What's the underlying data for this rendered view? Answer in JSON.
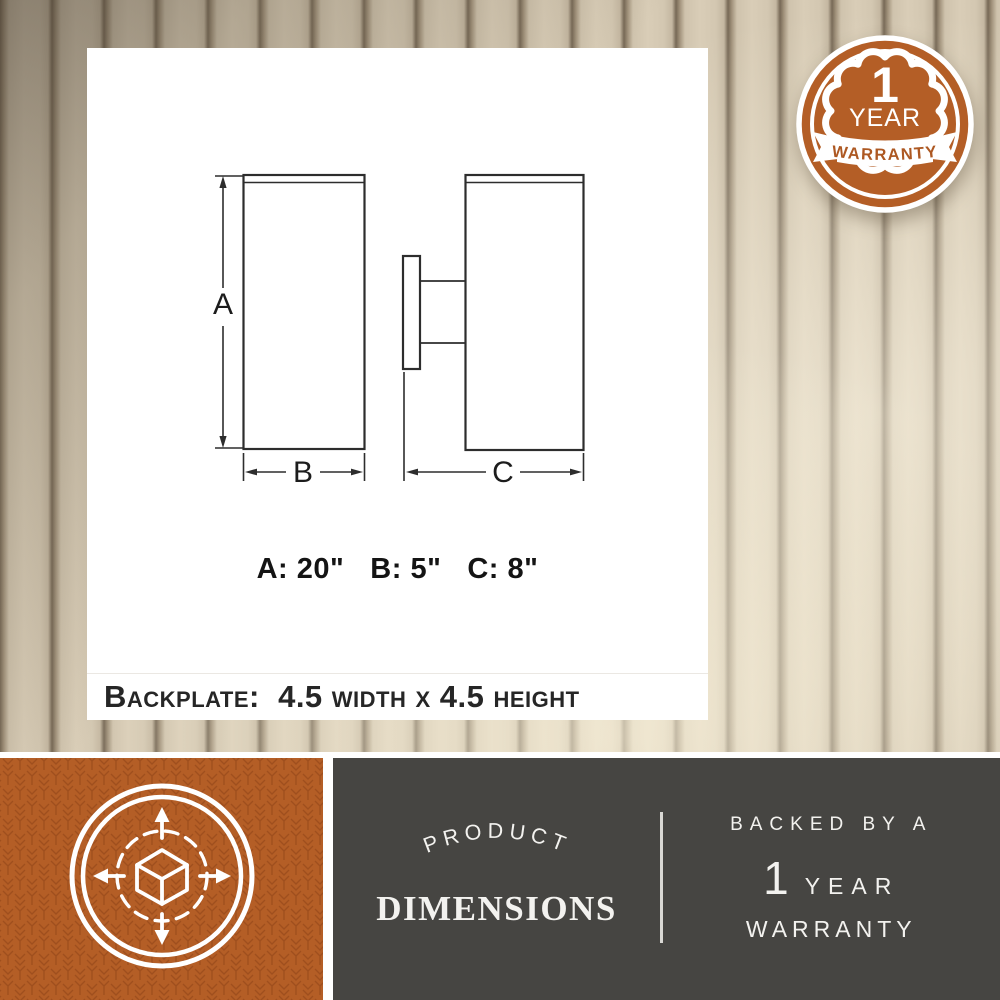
{
  "panel": {
    "labels": {
      "a": "A",
      "b": "B",
      "c": "C"
    },
    "dims": {
      "a": "A: 20\"",
      "b": "B: 5\"",
      "c": "C: 8\""
    },
    "backplate": "Backplate:  4.5 width x 4.5 height"
  },
  "badge": {
    "number": "1",
    "year": "YEAR",
    "banner": "WARRANTY"
  },
  "bottom": {
    "arc_text": "PRODUCT",
    "title": "DIMENSIONS",
    "backed": "BACKED BY A",
    "year_number": "1",
    "year_word": "YEAR",
    "warranty": "WARRANTY"
  },
  "icons": {
    "badge": "1-year-warranty-seal",
    "cube": "3d-cube-dimensions-icon"
  },
  "colors": {
    "orange": "#b45e26",
    "orange_pattern": "#9a4b1b",
    "dark_gray": "#464542",
    "wood_light": "#d9cdb7",
    "wood_groove": "#776956",
    "drawing_line": "#2d2d2d",
    "text_light": "#f3f2ef"
  }
}
